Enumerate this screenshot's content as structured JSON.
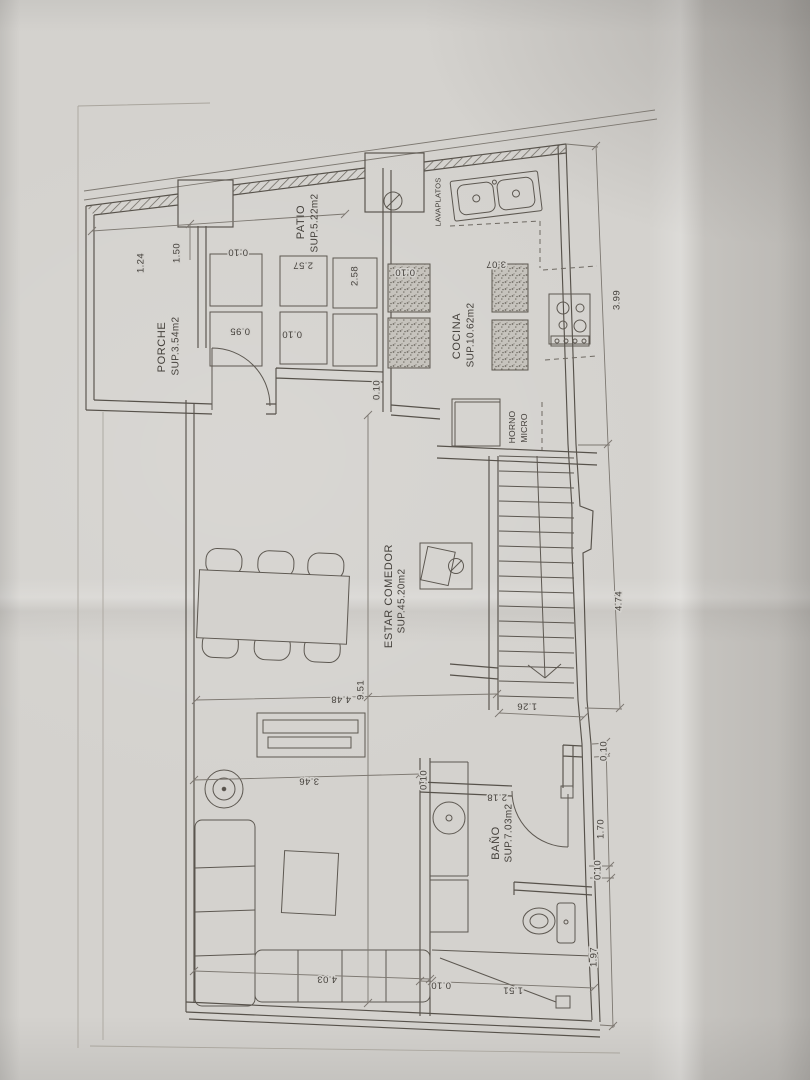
{
  "plan": {
    "rooms": [
      {
        "name": "PORCHE",
        "area": "SUP.3.54m2"
      },
      {
        "name": "PATIO",
        "area": "SUP.5.22m2"
      },
      {
        "name": "COCINA",
        "area": "SUP.10.62m2"
      },
      {
        "name": "ESTAR  COMEDOR",
        "area": "SUP.45.20m2"
      },
      {
        "name": "BAÑO",
        "area": "SUP.7.03m2"
      }
    ],
    "fixtures": {
      "sink": "LAVAPLATOS",
      "oven_line1": "HORNO",
      "oven_line2": "MICRO"
    },
    "dims": [
      "1.24",
      "1.50",
      "0.10",
      "2.57",
      "2.58",
      "0.10",
      "3.07",
      "0.95",
      "0.10",
      "0.10",
      "3.99",
      "4.74",
      "1.26",
      "0.10",
      "1.70",
      "0.10",
      "1.97",
      "0.10",
      "1.51",
      "4.48",
      "9.51",
      "3.46",
      "4.03",
      "2.18",
      "0.10"
    ],
    "colors": {
      "paper": "#d4d2ce",
      "line": "#57524b",
      "text": "#45413c"
    }
  }
}
